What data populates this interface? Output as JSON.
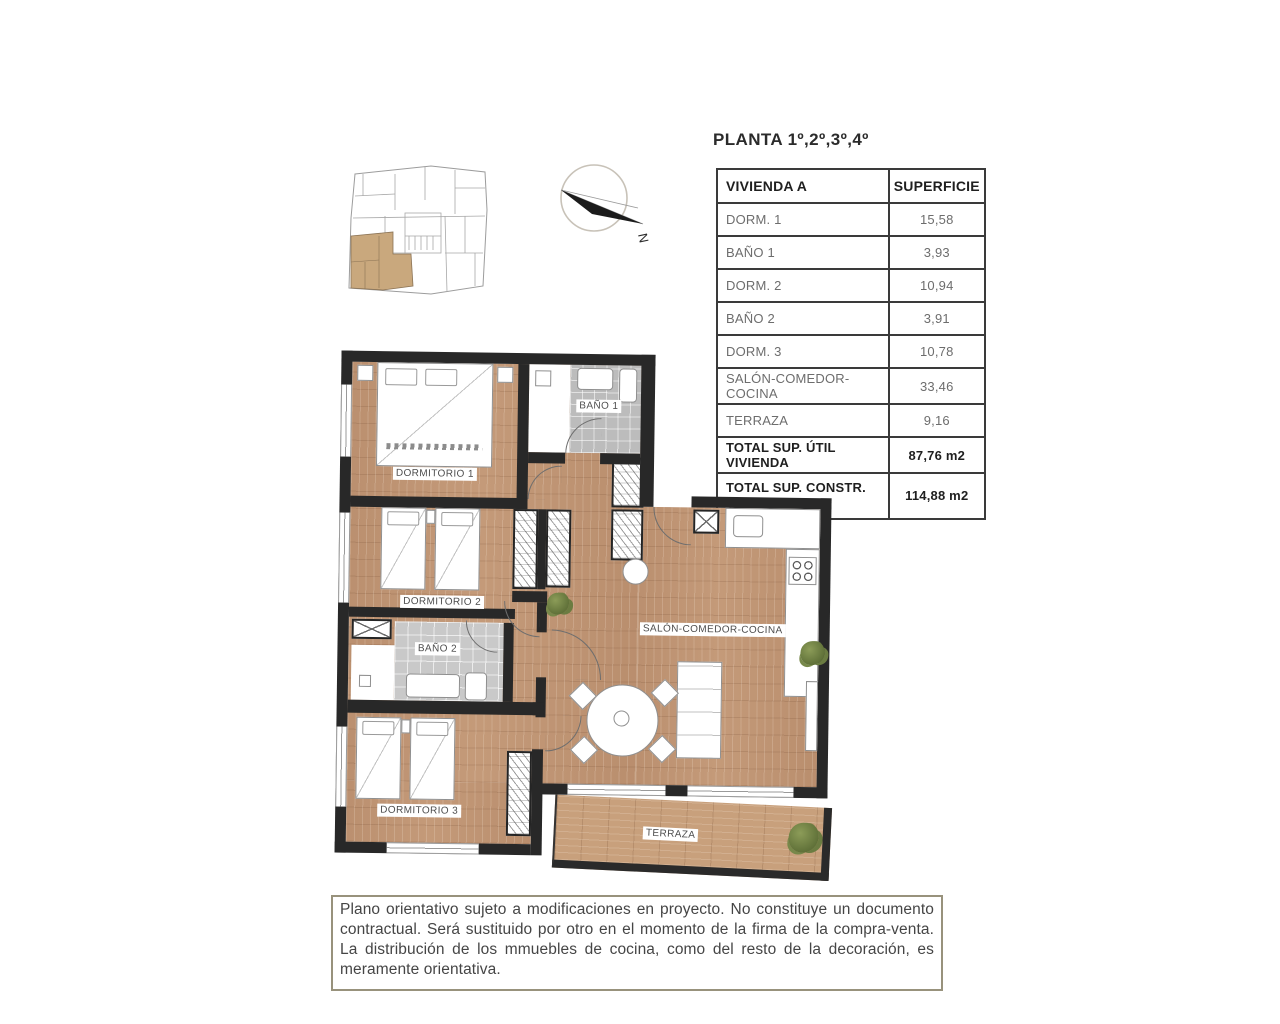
{
  "header": {
    "title": "PLANTA 1º,2º,3º,4º"
  },
  "compass": {
    "north_label": "N"
  },
  "area_table": {
    "columns": [
      "VIVIENDA A",
      "SUPERFICIE"
    ],
    "rows": [
      {
        "label": "DORM. 1",
        "value": "15,58"
      },
      {
        "label": "BAÑO 1",
        "value": "3,93"
      },
      {
        "label": "DORM. 2",
        "value": "10,94"
      },
      {
        "label": "BAÑO 2",
        "value": "3,91"
      },
      {
        "label": "DORM. 3",
        "value": "10,78"
      },
      {
        "label": "SALÓN-COMEDOR-COCINA",
        "value": "33,46"
      },
      {
        "label": "TERRAZA",
        "value": "9,16"
      }
    ],
    "totals": [
      {
        "label": "TOTAL SUP. ÚTIL VIVIENDA",
        "value": "87,76 m2"
      },
      {
        "label": "TOTAL SUP. CONSTR.",
        "label_line2": "VIV + PP +ZC",
        "value": "114,88 m2"
      }
    ]
  },
  "floor_plan": {
    "rooms": {
      "dorm1": "DORMITORIO 1",
      "bath1": "BAÑO 1",
      "dorm2": "DORMITORIO 2",
      "bath2": "BAÑO 2",
      "dorm3": "DORMITORIO 3",
      "salon": "SALÓN-COMEDOR-COCINA",
      "terrace": "TERRAZA"
    }
  },
  "disclaimer": {
    "text": "Plano orientativo sujeto a modificaciones en proyecto. No constituye un documento contractual. Será sustituido por otro en el momento de la firma de la compra-venta. La distribución de los mmuebles de cocina, como del resto de la decoración, es meramente orientativa."
  },
  "colors": {
    "wood": "#c49a79",
    "wall": "#282828",
    "tile": "#c3c3c3",
    "unit_highlight": "#c9a87d",
    "table_border": "#3a3a3a",
    "disclaimer_border": "#98927c"
  }
}
